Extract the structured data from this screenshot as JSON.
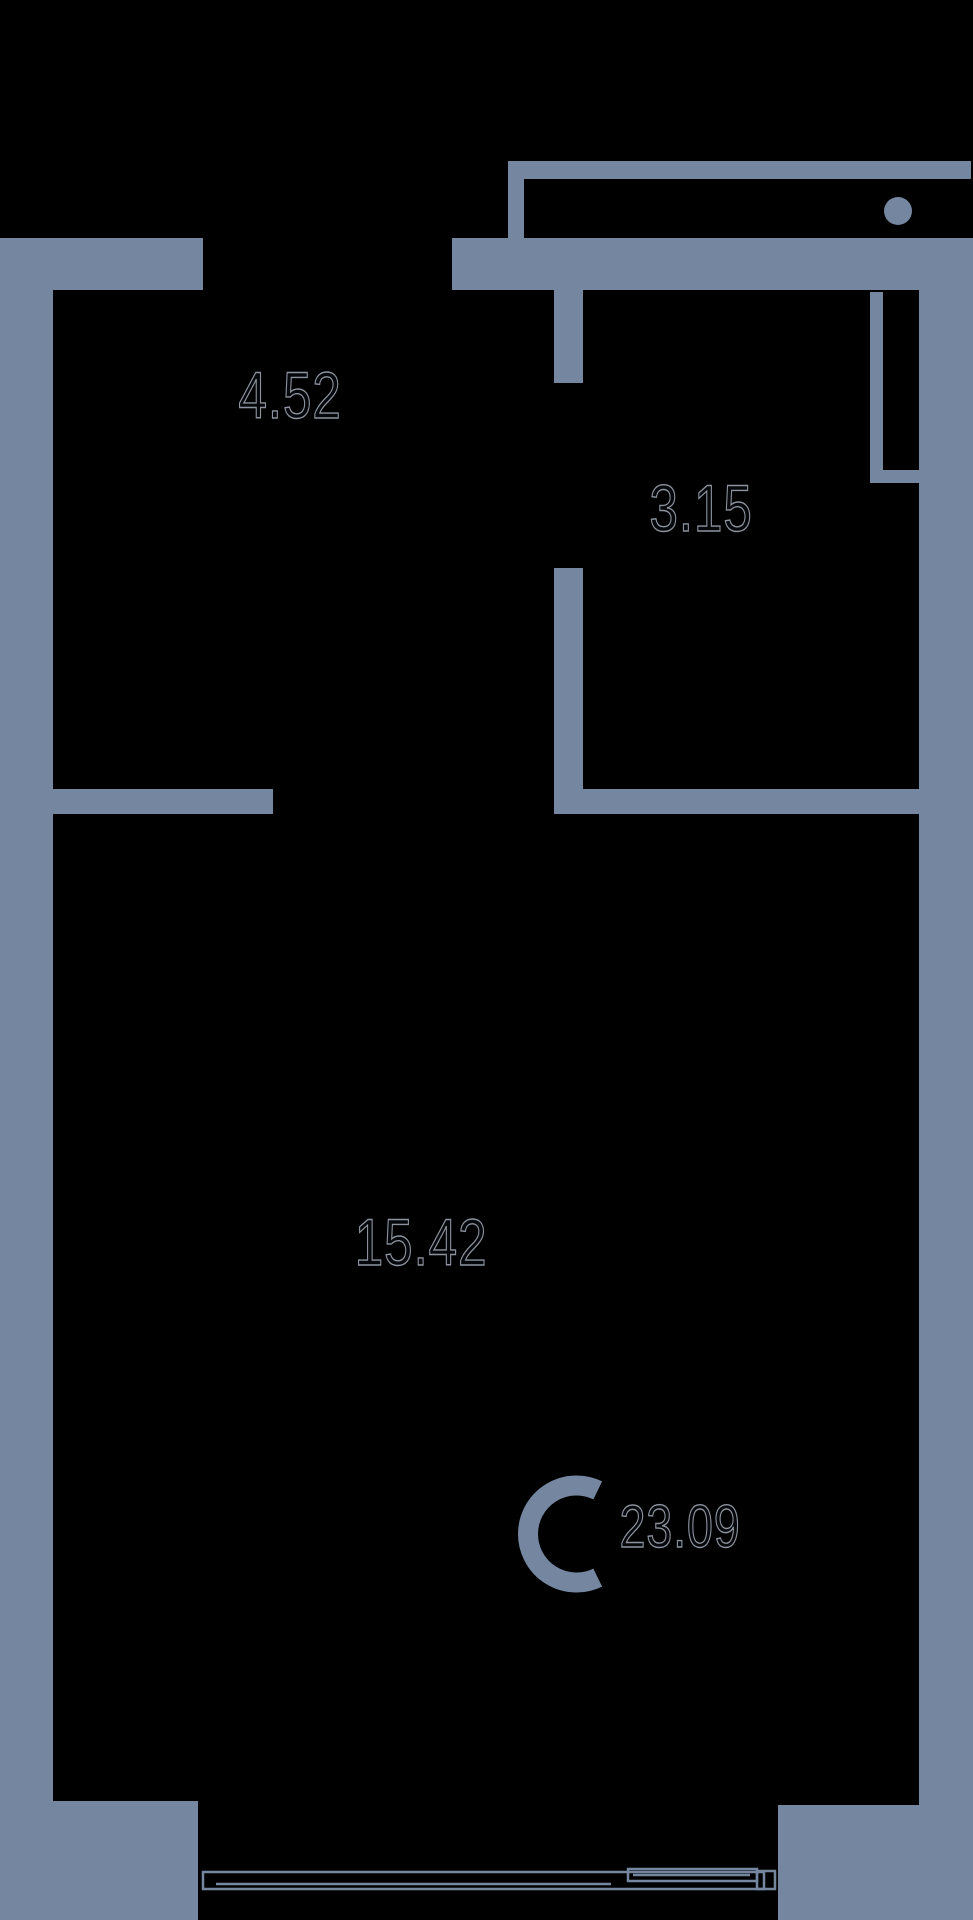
{
  "plan": {
    "title": "studio-apartment-floor-plan",
    "canvas": {
      "w": 973,
      "h": 1920
    },
    "background_color": "#000000",
    "wall_color": "#7586A1",
    "label_outline_color": "#8C939E",
    "walls": [
      {
        "name": "left-outer-wall",
        "x": 0,
        "y": 238,
        "w": 53,
        "h": 1563
      },
      {
        "name": "entry-wall-left-stub",
        "x": 0,
        "y": 238,
        "w": 203,
        "h": 52
      },
      {
        "name": "hall-top-wall",
        "x": 452,
        "y": 238,
        "w": 521,
        "h": 52
      },
      {
        "name": "vestibule-top-wall",
        "x": 508,
        "y": 161,
        "w": 463,
        "h": 18
      },
      {
        "name": "vestibule-left-stub",
        "x": 508,
        "y": 161,
        "w": 16,
        "h": 77
      },
      {
        "name": "bathroom-wall-upper",
        "x": 554,
        "y": 290,
        "w": 29,
        "h": 93
      },
      {
        "name": "bathroom-wall-lower",
        "x": 554,
        "y": 568,
        "w": 29,
        "h": 246
      },
      {
        "name": "mid-wall-left-segment",
        "x": 53,
        "y": 789,
        "w": 220,
        "h": 25
      },
      {
        "name": "mid-wall-right-segment",
        "x": 554,
        "y": 789,
        "w": 365,
        "h": 25
      },
      {
        "name": "vent-shaft-left-wall",
        "x": 870,
        "y": 292,
        "w": 13,
        "h": 178
      },
      {
        "name": "vent-shaft-bottom-wall",
        "x": 870,
        "y": 470,
        "w": 52,
        "h": 13
      },
      {
        "name": "right-outer-wall",
        "x": 919,
        "y": 238,
        "w": 54,
        "h": 1567
      },
      {
        "name": "bottom-right-wall-block",
        "x": 778,
        "y": 1805,
        "w": 195,
        "h": 115
      },
      {
        "name": "bottom-left-wall-block",
        "x": 0,
        "y": 1801,
        "w": 198,
        "h": 119
      }
    ],
    "door_knob": {
      "name": "door-knob",
      "cx": 898,
      "cy": 211,
      "r": 14
    },
    "window": {
      "stroke_width": 2.5,
      "frame": {
        "x": 203,
        "y": 1872,
        "w": 561,
        "h": 17
      },
      "inner_line": {
        "x1": 216,
        "y1": 1884,
        "x2": 611,
        "y2": 1884
      },
      "door_leaf": {
        "x": 628,
        "y": 1869,
        "w": 129,
        "h": 12
      },
      "leaf_inner_line": {
        "x1": 633,
        "y1": 1875,
        "x2": 750,
        "y2": 1875
      },
      "end_cap": {
        "x": 757,
        "y": 1871,
        "w": 18,
        "h": 18
      }
    },
    "compass": {
      "label": "C",
      "cx": 576.5,
      "cy": 1534,
      "r_mid": 48.5,
      "stroke_width": 20,
      "opening_half_angle_deg": 64
    }
  },
  "labels": {
    "rooms": [
      {
        "name": "room-area-hallway",
        "text": "4.52",
        "x": 290,
        "y": 395
      },
      {
        "name": "room-area-bathroom",
        "text": "3.15",
        "x": 701,
        "y": 508
      },
      {
        "name": "room-area-living",
        "text": "15.42",
        "x": 421,
        "y": 1242
      }
    ],
    "total": {
      "name": "total-area",
      "text": "23.09",
      "x": 680,
      "y": 1527
    }
  }
}
